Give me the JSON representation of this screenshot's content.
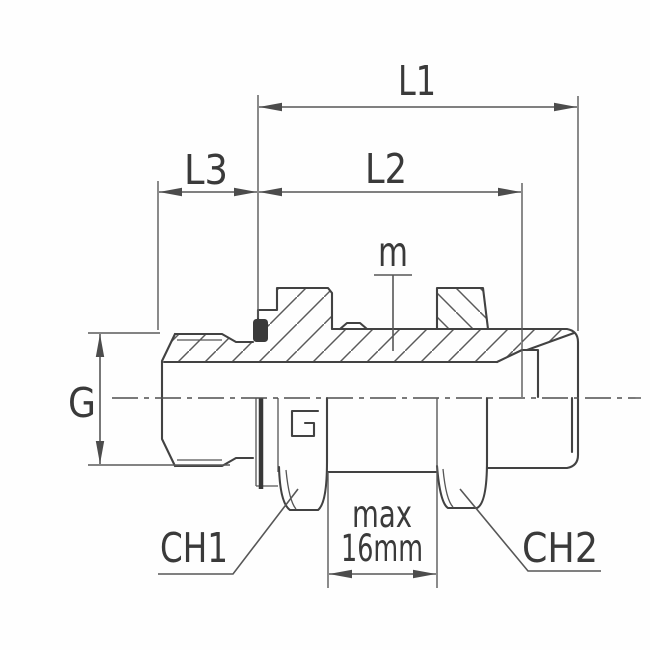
{
  "drawing": {
    "type": "technical-drawing-bulkhead-fitting-half-section",
    "labels": {
      "l1": "L1",
      "l3": "L3",
      "l2": "L2",
      "m": "m",
      "g": "G",
      "ch1": "CH1",
      "ch2": "CH2"
    },
    "note": {
      "line1": "max",
      "line2": "16mm"
    },
    "colors": {
      "line": "#454545",
      "dim": "#575757",
      "text": "#3a3a3a",
      "seal": "#3a3a3a",
      "background": "#fefefe"
    }
  }
}
